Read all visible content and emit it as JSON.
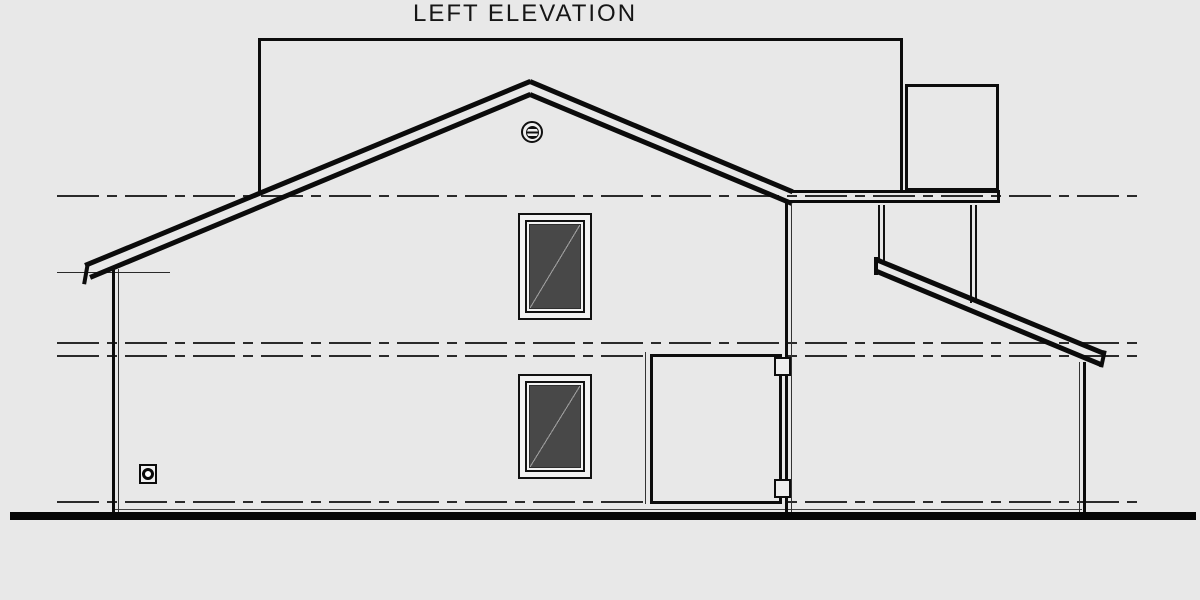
{
  "drawing": {
    "title": "LEFT ELEVATION",
    "kind": "architectural elevation drawing, black linework on light gray",
    "colors": {
      "background": "#e8e8e8",
      "linework": "#0b0b0b",
      "window_glass": "#484848",
      "glass_diagonal": "#9b9b9b",
      "ground_line": "#050505",
      "datum_line": "#2a2a2a"
    },
    "components": {
      "main_roof": "gable roof drawn with double rake band, peak near center",
      "gable_vent": "round louvered vent below roof peak",
      "rear_wall_outline": "tall rectangle of rear wing visible beyond roof",
      "rear_extension_outline": "smaller rectangle at upper right beyond roof",
      "eave_fascia": "horizontal double fascia band right of roof slope",
      "shed_roof": "sloped shed roof band hung from fascia on right side",
      "windows": [
        "upper floor window with diagonal glass mark",
        "main floor window with diagonal glass mark"
      ],
      "gate_panel": "rectangular side gate panel with two hinge brackets",
      "wall_vent": "small square wall vent with round ring near lower left",
      "datum_lines": [
        "upper plate level",
        "second floor level (upper)",
        "second floor level (lower)",
        "first floor level"
      ],
      "ground": "heavy ground line across bottom"
    }
  }
}
